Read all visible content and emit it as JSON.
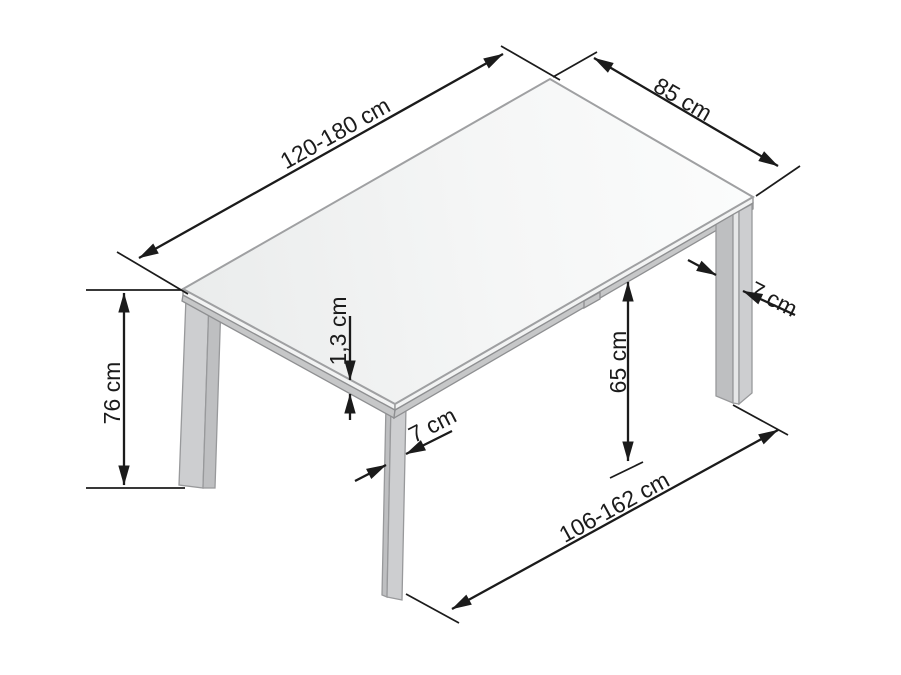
{
  "diagram": {
    "subject": "extendable-rectangular-dining-table",
    "unit": "cm",
    "labels": {
      "length": "120-180 cm",
      "depth": "85 cm",
      "height": "76 cm",
      "top_thickness": "1,3 cm",
      "front_leg_width": "7 cm",
      "right_leg_width": "7 cm",
      "underside_clearance": "65 cm",
      "leg_span": "106-162 cm"
    },
    "colors": {
      "ink": "#1b1b1b",
      "outline": "#98999b",
      "top_edge_glass": "#f2f3f3",
      "top_edge_frame": "#c6c7c8",
      "leg_face": "#cdced0",
      "leg_shade": "#bebfc1",
      "leg_highlight": "#e6e7e8",
      "background": "#ffffff"
    }
  }
}
